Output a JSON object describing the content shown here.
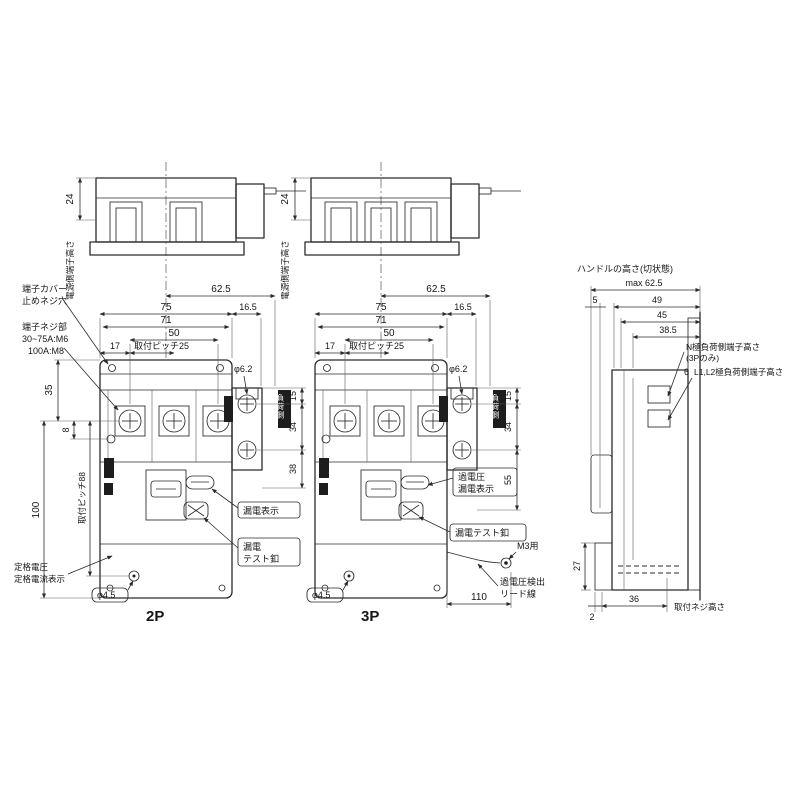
{
  "colors": {
    "line": "#2b2b2b",
    "background": "#ffffff"
  },
  "top_views": {
    "terminal_height": "電源側端子高さ",
    "d24": "24"
  },
  "front_dims": {
    "d625": "62.5",
    "d75": "75",
    "d165": "16.5",
    "d71": "71",
    "d50": "50",
    "d17": "17",
    "pitch25": "取付ピッチ25"
  },
  "p2": {
    "title": "2P",
    "cover1": "端子カバー",
    "cover2": "止めネジ穴",
    "screw1": "端子ネジ部",
    "screw2": "30~75A:M6",
    "screw3": "100A:M8",
    "rating1": "定格電圧",
    "rating2": "定格電流表示",
    "d35": "35",
    "d8": "8",
    "pitch88": "取付ピッチ88",
    "d100": "100",
    "phi62": "φ6.2",
    "d15": "15",
    "d34": "34",
    "d38": "38",
    "phi45": "φ4.5",
    "ind": "漏電表示",
    "test1": "漏電",
    "test2": "テスト釦",
    "badge": "負荷側"
  },
  "p3": {
    "title": "3P",
    "phi62": "φ6.2",
    "d15": "15",
    "d34": "34",
    "d55": "55",
    "phi45": "φ4.5",
    "d110": "110",
    "ind1": "過電圧",
    "ind2": "漏電表示",
    "test": "漏電テスト釦",
    "m3": "M3用",
    "lead1": "過電圧検出",
    "lead2": "リード線",
    "badge": "負荷側"
  },
  "side": {
    "title": "ハンドルの高さ(切状態)",
    "dmax": "max 62.5",
    "d5": "5",
    "d49": "49",
    "d45": "45",
    "d385": "38.5",
    "n1": "N極負荷側端子高さ",
    "n2": "(3Pのみ)",
    "d6": "6",
    "l12": "L1,L2極負荷側端子高さ",
    "d27": "27",
    "d2": "2",
    "d36": "36",
    "mount": "取付ネジ高さ"
  }
}
